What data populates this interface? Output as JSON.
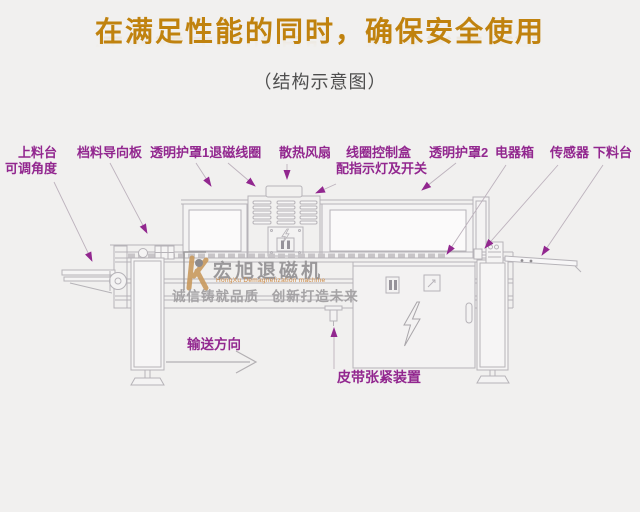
{
  "page": {
    "title": "在满足性能的同时，确保安全使用",
    "subtitle": "（结构示意图）"
  },
  "part_labels": [
    {
      "id": "feed-table",
      "text": "上料台",
      "text2": "可调角度"
    },
    {
      "id": "stock-guide-plate",
      "text": "档料导向板"
    },
    {
      "id": "clear-cover-1-degauss-coil",
      "text": "透明护罩1退磁线圈"
    },
    {
      "id": "cooling-fan",
      "text": "散热风扇"
    },
    {
      "id": "coil-control-box",
      "text": "线圈控制盒",
      "text2": "配指示灯及开关"
    },
    {
      "id": "clear-cover-2",
      "text": "透明护罩2"
    },
    {
      "id": "electrical-box",
      "text": "电器箱"
    },
    {
      "id": "sensor",
      "text": "传感器"
    },
    {
      "id": "discharge-table",
      "text": "下料台"
    }
  ],
  "annotations": {
    "conveyor_direction": "输送方向",
    "belt_tensioner": "皮带张紧装置"
  },
  "watermark": {
    "brand": "宏旭退磁机",
    "brand_en": "HongXu Demagnetization machine",
    "slogan": "诚信铸就品质 创新打造未来"
  },
  "colors": {
    "background": "#f1f0ef",
    "title_gold": "#c0820e",
    "subtitle_gray": "#4e4e4e",
    "label_magenta": "#92278f",
    "drawing_line": "#b6b3b8",
    "watermark_gray": "#9a989a",
    "watermark_orange": "#cd8a45"
  }
}
